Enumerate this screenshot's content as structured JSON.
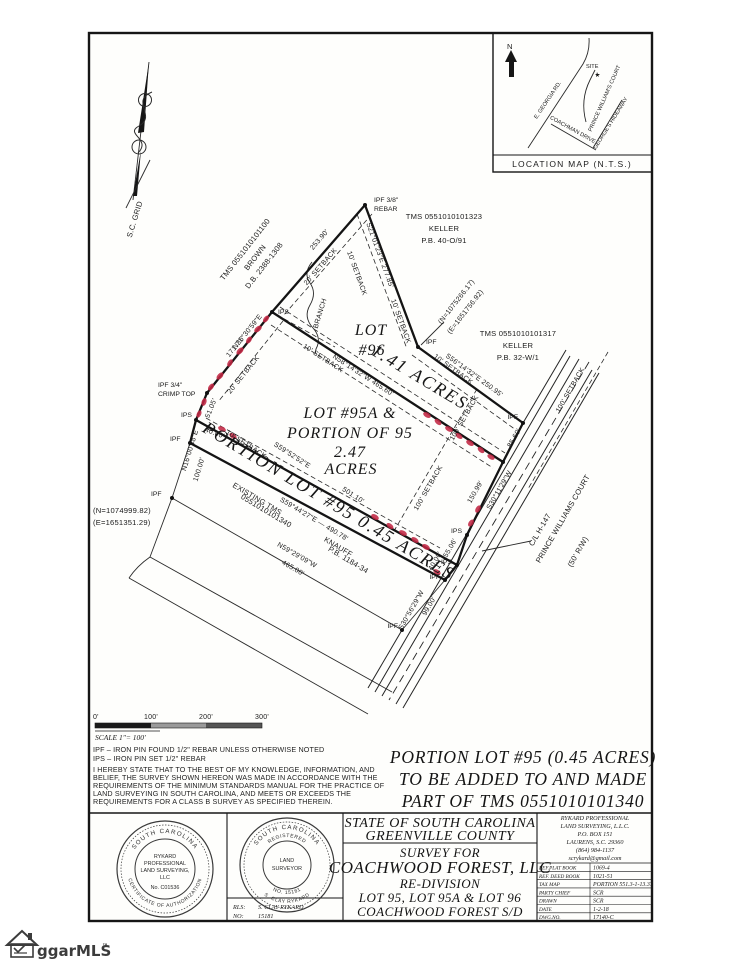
{
  "north_arrow": {
    "label": "S.C. GRID"
  },
  "location_map": {
    "north": "N",
    "site": "SITE",
    "caption": "LOCATION MAP  (N.T.S.)",
    "roads": {
      "georgia": "E. GEORGIA RD.",
      "coachman": "COACHMAN DRIVE",
      "prince": "PRINCE WILLIAM'S COURT",
      "georges": "GEORGE'S HIDEAWAY"
    }
  },
  "adjoiners": {
    "brown": {
      "l1": "TMS 0551010101100",
      "l2": "BROWN",
      "l3": "D.B. 2388-1308"
    },
    "keller1": {
      "l1": "TMS 0551010101323",
      "l2": "KELLER",
      "l3": "P.B. 40-O/91"
    },
    "keller2": {
      "l1": "TMS 0551010101317",
      "l2": "KELLER",
      "l3": "P.B. 32-W/1"
    },
    "knauff": {
      "l1": "EXISTING TMS",
      "l2": "0551010101340",
      "l3": "KNAUFF",
      "l4": "P.B. 1184-34"
    }
  },
  "lots": {
    "lot96": {
      "name": "LOT",
      "num": "#96",
      "area": "1.41 ACRES"
    },
    "lot95a": {
      "l1": "LOT #95A &",
      "l2": "PORTION OF 95",
      "l3": "2.47",
      "l4": "ACRES"
    },
    "portion95": "PORTION LOT #95  0.45 ACRES"
  },
  "dims": {
    "d253": "253.90'",
    "d277": "S21°01'23\"E  277.85'",
    "d250": "S56°14'32\"E  250.95'",
    "d465": "N58°14'32\"W  465.60'",
    "b171a": "N36°30'59\"E",
    "b171b": "171.71'",
    "d51": "51.05'",
    "d40w": "40.00'",
    "b100a": "N16°00'48\"E",
    "b100b": "100.00'",
    "b501a": "S59°52'52\"E",
    "b501b": "501.10'",
    "d490": "S59°44'27\"E — 490.78'",
    "b465a": "N59°29'09\"W",
    "b465b": "465.00'",
    "b99a": "S30°56'29\"W",
    "b99b": "99.00'",
    "d85": "85.60'",
    "b150a": "S30°11'29\"W",
    "b150b": "150.99'",
    "d55": "55.06'",
    "d40r": "40.00'"
  },
  "setbacks": {
    "s10": "10' SETBACK",
    "s20": "20' SETBACK",
    "s100": "100' SETBACK"
  },
  "road": {
    "l1": "C/L  H-147",
    "l2": "PRINCE  WILLIAMS  COURT",
    "l3": "(50'  R/W)"
  },
  "features": {
    "branch": "BRANCH"
  },
  "monuments": {
    "ipf": "IPF",
    "ips": "IPS",
    "ipf38": "IPF 3/8\"",
    "rebar": "REBAR",
    "ipf34": "IPF 3/4\"",
    "crimp": "CRIMP TOP"
  },
  "coords": {
    "ne_n": "(N=1075266.17)",
    "ne_e": "(E=1651756.92)",
    "sw_n": "(N=1074999.82)",
    "sw_e": "(E=1651351.29)"
  },
  "scalebar": {
    "t0": "0'",
    "t100": "100'",
    "t200": "200'",
    "t300": "300'",
    "scale": "SCALE 1\"= 100'"
  },
  "notes": {
    "n1": "IPF – IRON PIN FOUND 1/2\" REBAR UNLESS OTHERWISE NOTED",
    "n2": "IPS – IRON PIN SET 1/2\" REBAR",
    "cert": [
      "I HEREBY STATE THAT TO THE BEST OF MY KNOWLEDGE, INFORMATION, AND",
      "BELIEF, THE SURVEY SHOWN HEREON WAS MADE IN ACCORDANCE WITH THE",
      "REQUIREMENTS OF THE MINIMUM STANDARDS MANUAL FOR THE PRACTICE OF",
      "LAND SURVEYING IN SOUTH CAROLINA, AND MEETS OR EXCEEDS THE",
      "REQUIREMENTS FOR A CLASS B SURVEY AS SPECIFIED THEREIN."
    ]
  },
  "statement": {
    "l1": "PORTION LOT #95 (0.45 ACRES)",
    "l2": "TO BE ADDED TO AND MADE",
    "l3": "PART OF TMS 0551010101340"
  },
  "title_block": {
    "state": "STATE OF SOUTH CAROLINA",
    "county": "GREENVILLE COUNTY",
    "survey_for": "SURVEY FOR",
    "client": "COACHWOOD FOREST, LLC",
    "subtitle": "RE-DIVISION",
    "lots_line": "LOT 95, LOT 95A & LOT 96",
    "subdivision": "COACHWOOD FOREST S/D"
  },
  "firm": {
    "name1": "RYKARD PROFESSIONAL",
    "name2": "LAND SURVEYING, L.L.C.",
    "addr1": "P.O. BOX 151",
    "addr2": "LAURENS, S.C. 29360",
    "phone": "(864) 984-1137",
    "email": "scrykard@gmail.com",
    "rows": [
      {
        "label": "REF.PLAT BOOK",
        "value": "1069-4"
      },
      {
        "label": "REF. DEED BOOK",
        "value": "1021-51"
      },
      {
        "label": "TAX MAP",
        "value": "PORTION 551.3-1-13.37"
      },
      {
        "label": "PARTY CHIEF",
        "value": "SCR"
      },
      {
        "label": "DRAWN",
        "value": "SCR"
      },
      {
        "label": "DATE",
        "value": "1-2-18"
      },
      {
        "label": "DWG.NO.",
        "value": "17140-C"
      }
    ]
  },
  "seal1": {
    "arc_top": "SOUTH CAROLINA",
    "arc_bottom": "CERTIFICATE OF AUTHORIZATION",
    "c1": "RYKARD",
    "c2": "PROFESSIONAL",
    "c3": "LAND SURVEYING,",
    "c4": "LLC",
    "c5": "No. C01536"
  },
  "seal2": {
    "arc_top": "SOUTH CAROLINA",
    "arc_top2": "REGISTERED",
    "c1": "LAND",
    "c2": "SURVEYOR",
    "arc_bottom": "S. CLAY RYKARD",
    "arc_bottom2": "NO. 15181"
  },
  "rls": {
    "label1": "RLS:",
    "value1": "S. CLAY RYKARD",
    "label2": "NO:",
    "value2": "15181"
  },
  "watermark": {
    "brand": "ggarMLS",
    "tm": "™"
  }
}
